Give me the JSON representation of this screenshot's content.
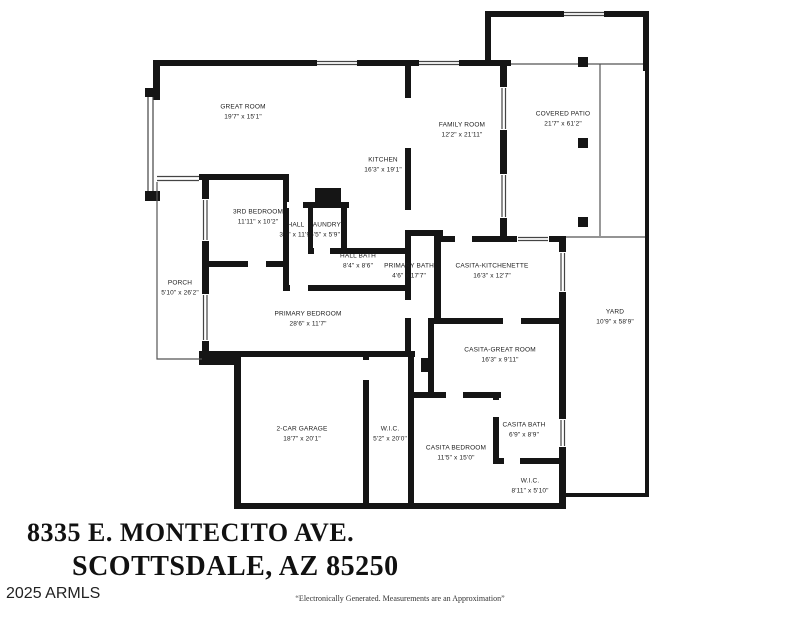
{
  "address": {
    "line1": "8335 E. MONTECITO AVE.",
    "line2": "SCOTTSDALE, AZ 85250",
    "credit": "2025 ARMLS",
    "disclaimer": "“Electronically Generated.  Measurements are an Approximation”"
  },
  "colors": {
    "wall": "#151515",
    "background": "#ffffff",
    "thin_line": "#555555",
    "window_line": "#444444",
    "text": "#1c1c1c"
  },
  "rooms": [
    {
      "name": "GREAT ROOM",
      "dims": "19'7\" x 15'1\""
    },
    {
      "name": "KITCHEN",
      "dims": "16'3\" x 19'1\""
    },
    {
      "name": "FAMILY ROOM",
      "dims": "12'2\" x 21'11\""
    },
    {
      "name": "COVERED PATIO",
      "dims": "21'7\" x 61'2\""
    },
    {
      "name": "3RD BEDROOM",
      "dims": "11'11\" x 10'2\""
    },
    {
      "name": "HALL",
      "dims": "3'9\" x 11'9\""
    },
    {
      "name": "LAUNDRY",
      "dims": "6'5\" x 5'9\""
    },
    {
      "name": "HALL BATH",
      "dims": "8'4\" x 8'6\""
    },
    {
      "name": "PRIMARY BATH",
      "dims": "4'6\" x 17'7\""
    },
    {
      "name": "CASITA-KITCHENETTE",
      "dims": "16'3\" x 12'7\""
    },
    {
      "name": "PORCH",
      "dims": "5'10\" x 26'2\""
    },
    {
      "name": "PRIMARY BEDROOM",
      "dims": "28'6\" x 11'7\""
    },
    {
      "name": "CASITA-GREAT ROOM",
      "dims": "16'3\" x 9'11\""
    },
    {
      "name": "YARD",
      "dims": "10'9\" x 58'9\""
    },
    {
      "name": "2-CAR GARAGE",
      "dims": "18'7\" x 20'1\""
    },
    {
      "name": "W.I.C.",
      "dims": "5'2\" x 20'0\""
    },
    {
      "name": "CASITA BEDROOM",
      "dims": "11'5\" x 15'0\""
    },
    {
      "name": "CASITA BATH",
      "dims": "6'9\" x 8'9\""
    },
    {
      "name": "W.I.C.",
      "dims": "8'11\" x 5'10\""
    }
  ]
}
